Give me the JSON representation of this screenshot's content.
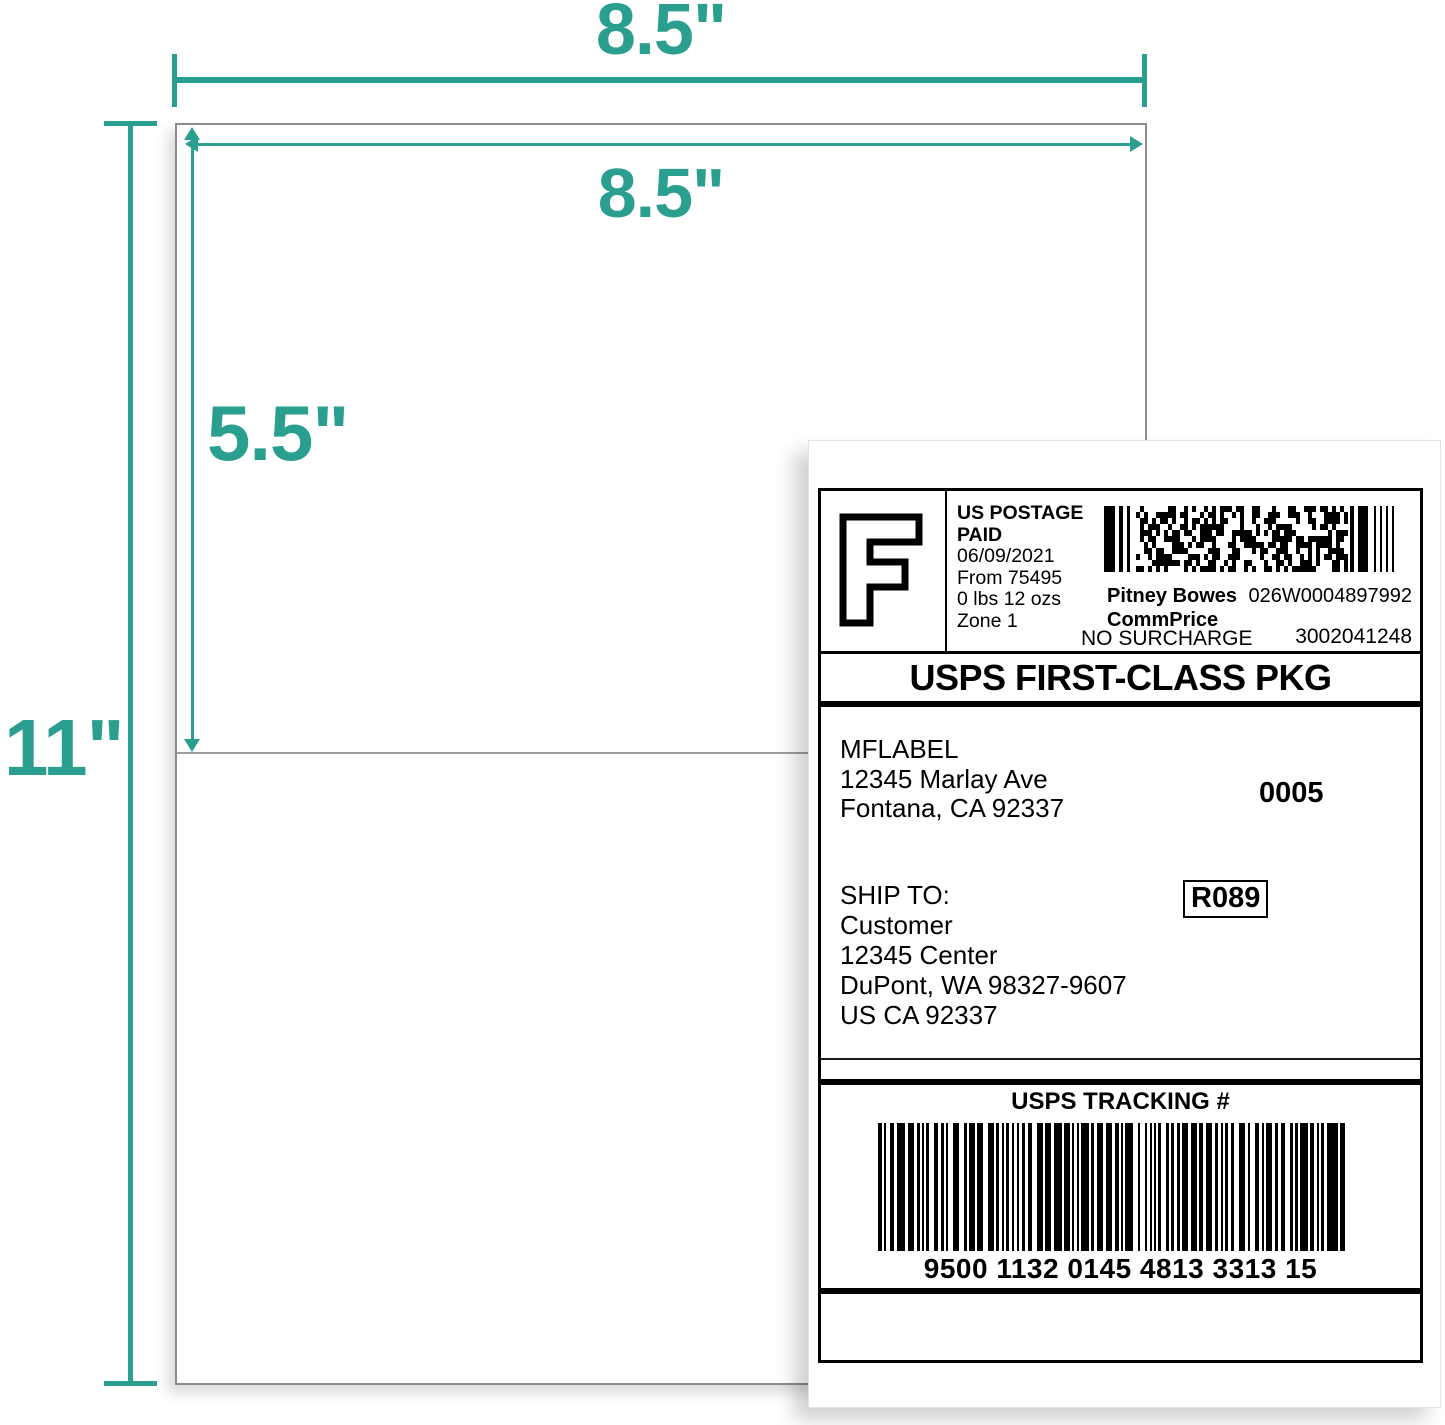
{
  "colors": {
    "accent_teal": "#2a9e8f",
    "sheet_border_gray": "#8c8c8c",
    "divider_gray": "#9e9e9e"
  },
  "annotations": {
    "sheet_width": "8.5\"",
    "label_width": "8.5\"",
    "label_height": "5.5\"",
    "sheet_height": "11\""
  },
  "label": {
    "postage": {
      "fim_letter": "F",
      "line1": "US POSTAGE",
      "line2": "PAID",
      "date": "06/09/2021",
      "origin": "From 75495",
      "weight": "0 lbs 12 ozs",
      "zone": "Zone 1",
      "carrier": "Pitney Bowes",
      "rate_type": "CommPrice",
      "surcharge": "NO SURCHARGE",
      "meter_id": "026W0004897992",
      "serial": "3002041248"
    },
    "service_banner": "USPS FIRST-CLASS PKG",
    "sender": {
      "name": "MFLABEL",
      "street": "12345 Marlay Ave",
      "city": "Fontana, CA 92337"
    },
    "batch_number": "0005",
    "ship_to_heading": "SHIP TO:",
    "recipient": {
      "name": "Customer",
      "street": "12345 Center",
      "city": "DuPont, WA 98327-9607",
      "country": "US CA 92337"
    },
    "route_code": "R089",
    "tracking": {
      "heading": "USPS TRACKING #",
      "number": "9500 1132 0145 4813 3313 15"
    }
  }
}
